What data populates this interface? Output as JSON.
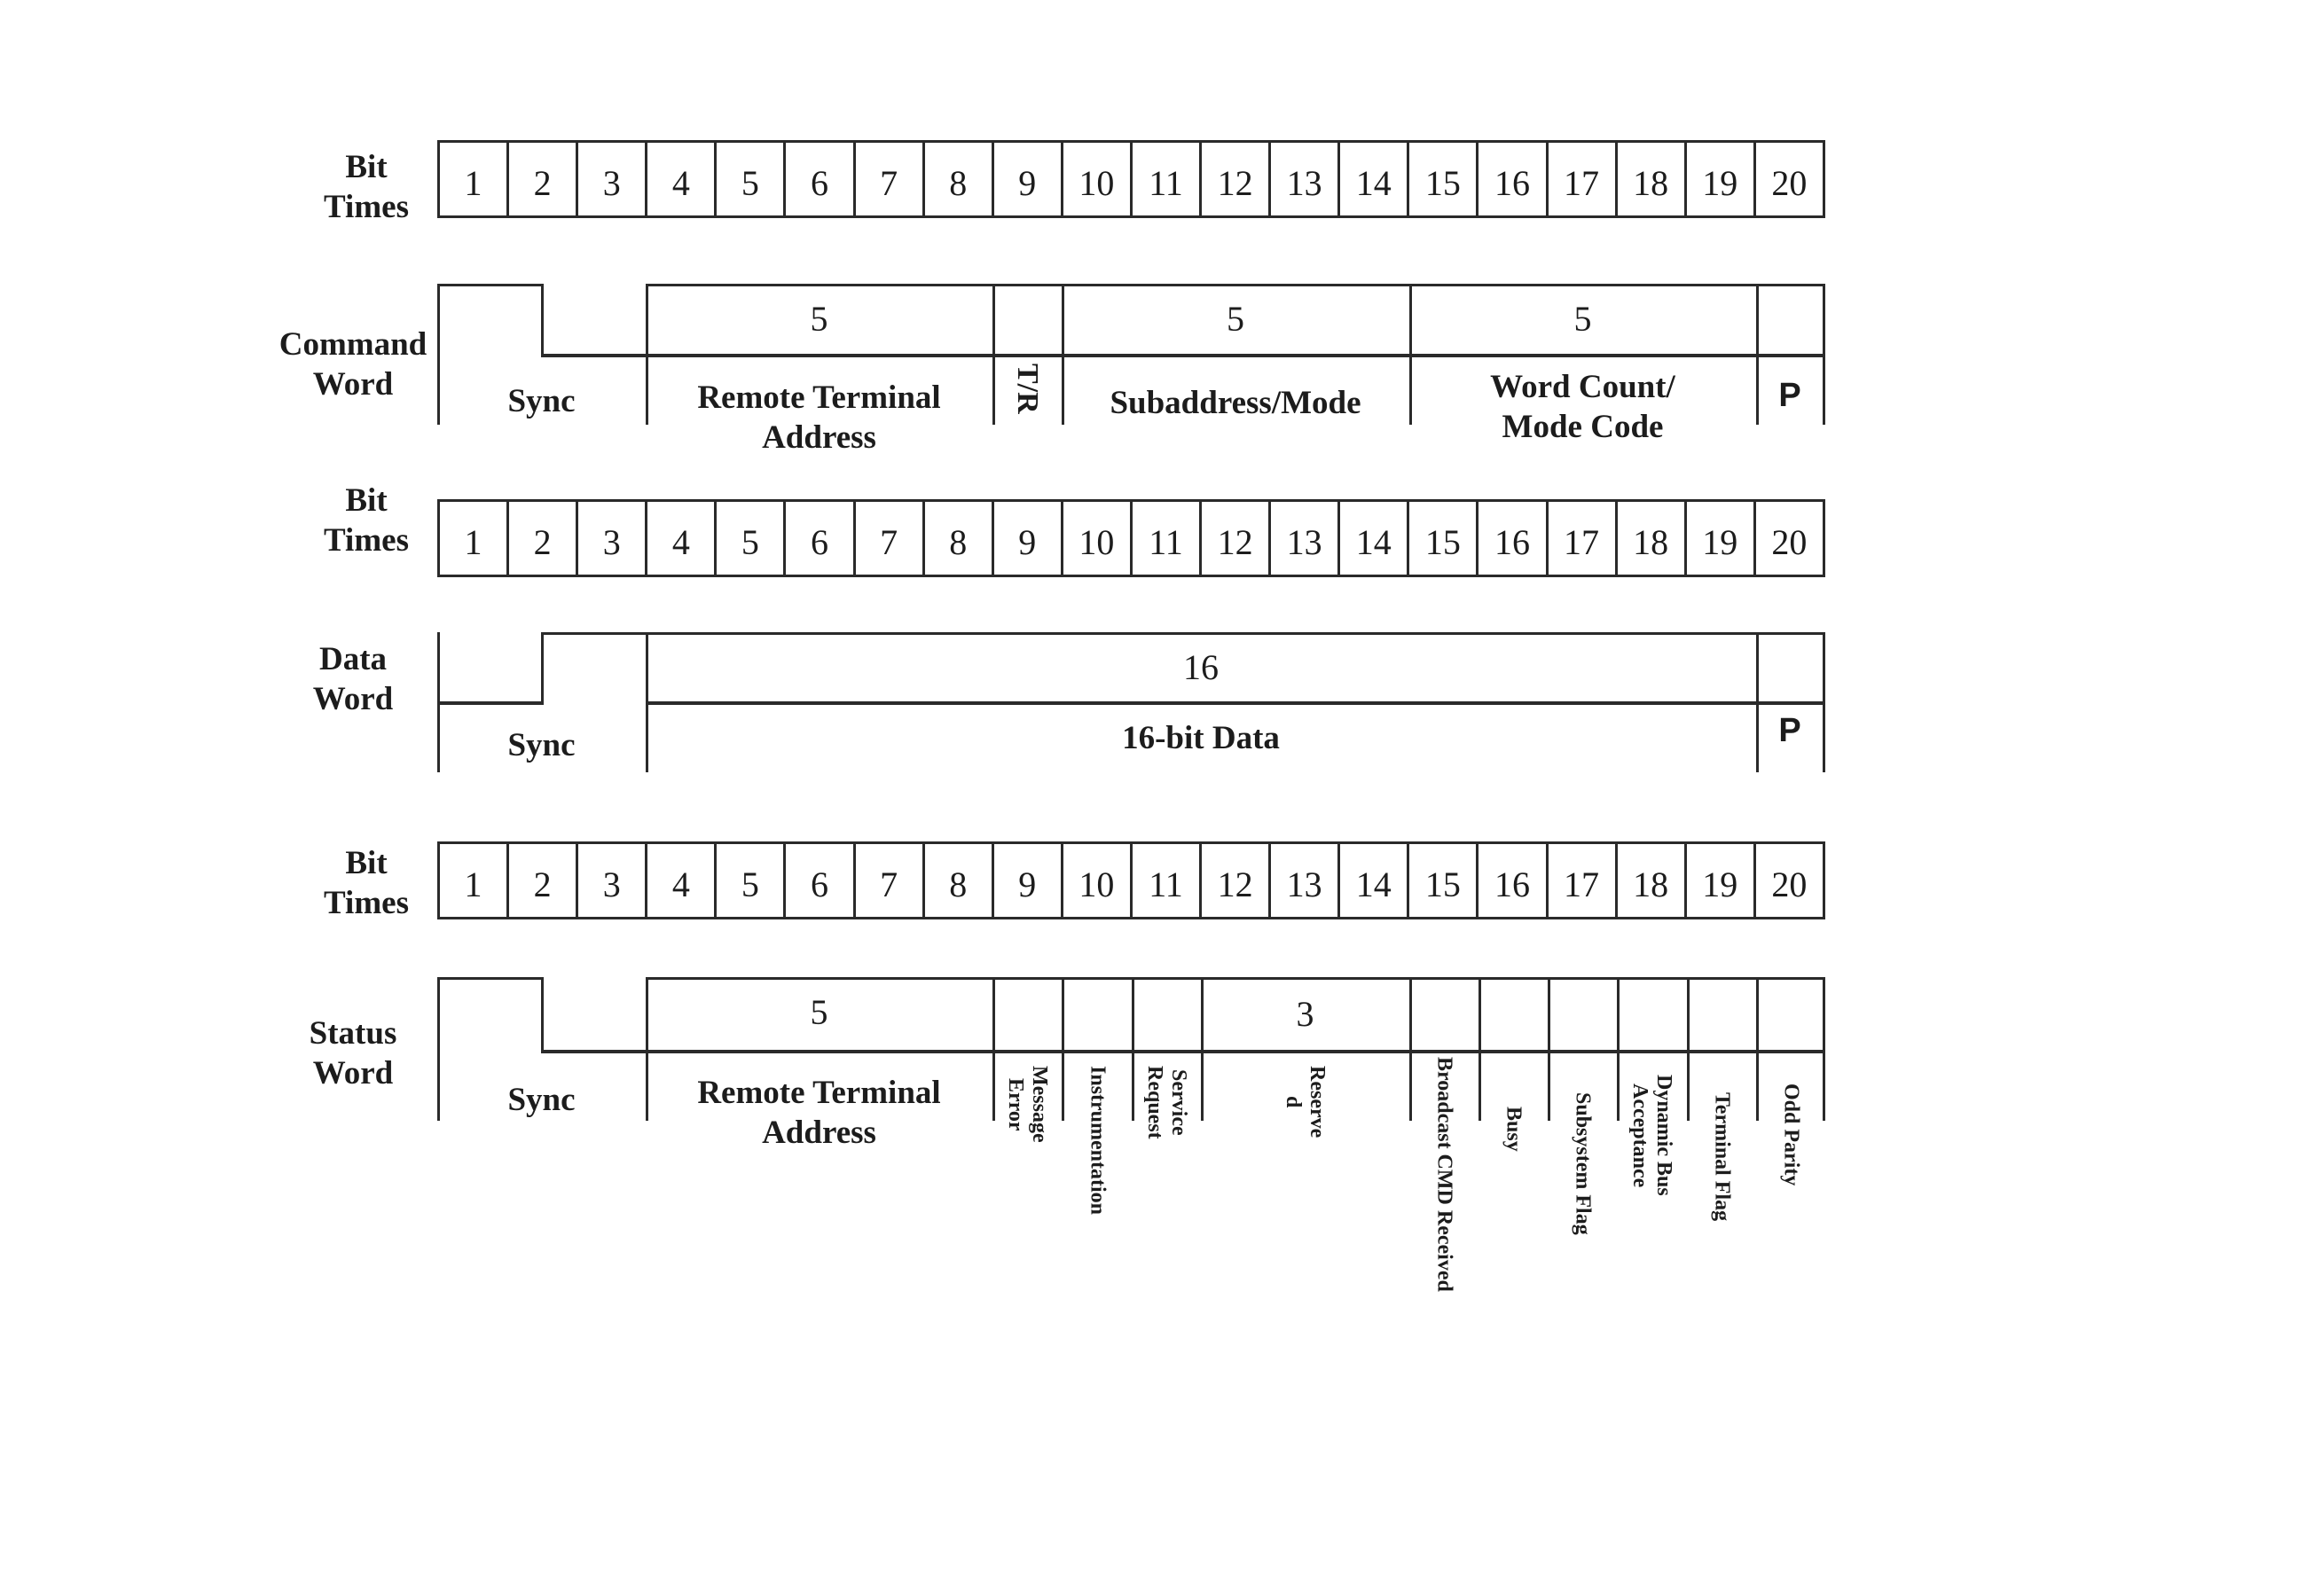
{
  "bit_times": {
    "label": "Bit\nTimes",
    "numbers": [
      "1",
      "2",
      "3",
      "4",
      "5",
      "6",
      "7",
      "8",
      "9",
      "10",
      "11",
      "12",
      "13",
      "14",
      "15",
      "16",
      "17",
      "18",
      "19",
      "20"
    ]
  },
  "command_word": {
    "title": "Command\nWord",
    "sync_label": "Sync",
    "rta_count": "5",
    "rta_label": "Remote Terminal\nAddress",
    "tr_label": "T/R",
    "subaddress_count": "5",
    "subaddress_label": "Subaddress/Mode",
    "word_count_count": "5",
    "word_count_label": "Word Count/\nMode Code",
    "parity_label": "P"
  },
  "data_word": {
    "title": "Data\nWord",
    "sync_label": "Sync",
    "data_count": "16",
    "data_label": "16-bit Data",
    "parity_label": "P"
  },
  "status_word": {
    "title": "Status\nWord",
    "sync_label": "Sync",
    "rta_count": "5",
    "rta_label": "Remote Terminal\nAddress",
    "reserved_count": "3",
    "bits": {
      "message_error": "Message\nError",
      "instrumentation": "Instrumentation",
      "service_request": "Service\nRequest",
      "reserved": "Reserve\nd",
      "broadcast_cmd_received": "Broadcast CMD Received",
      "busy": "Busy",
      "subsystem_flag": "Subsystem Flag",
      "dynamic_bus_acceptance": "Dynamic Bus\nAcceptance",
      "terminal_flag": "Terminal Flag",
      "odd_parity": "Odd Parity"
    }
  }
}
